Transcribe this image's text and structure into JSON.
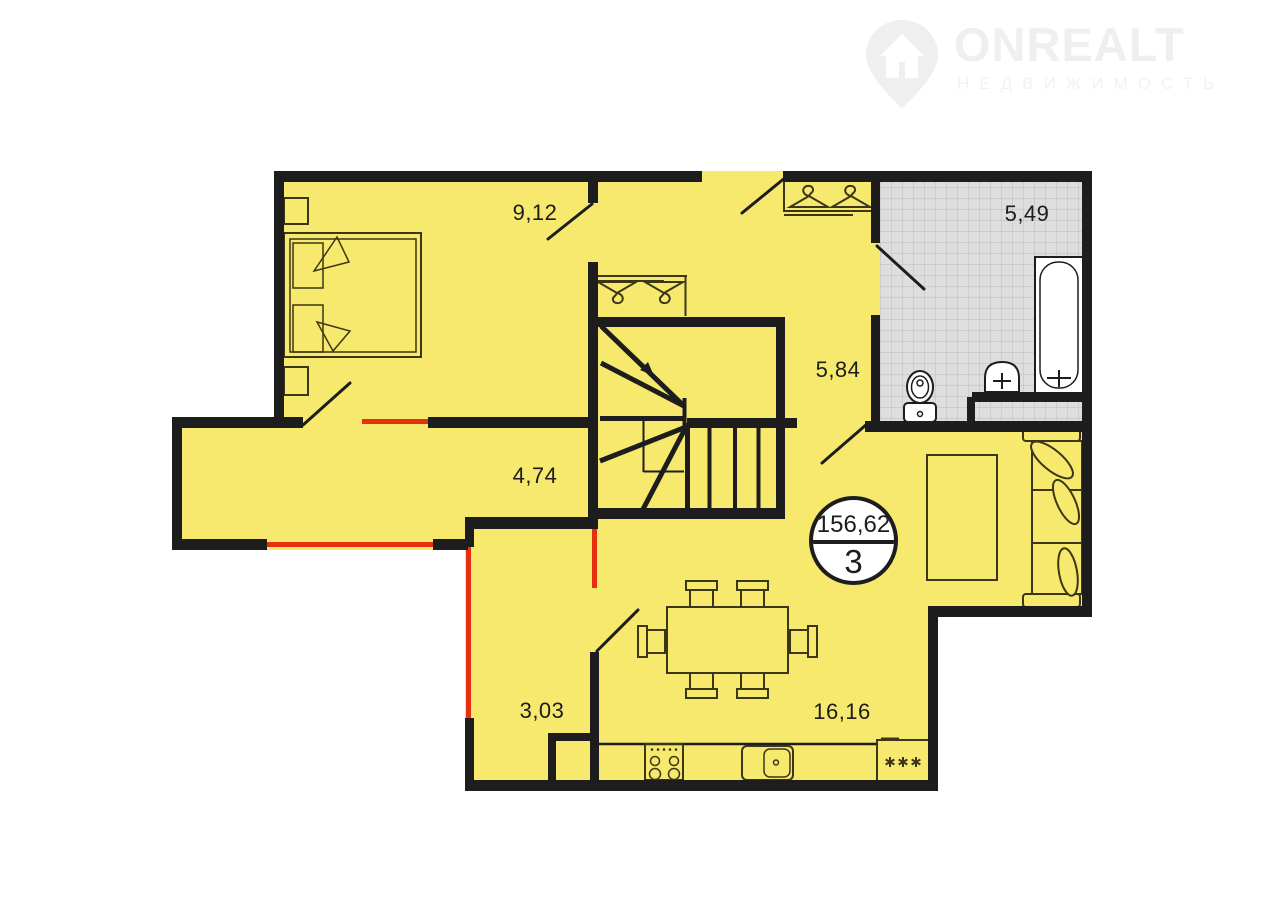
{
  "logo": {
    "brand": "ONREALT",
    "subtitle": "НЕДВИЖИМОСТЬ",
    "icon": "house-pin-icon"
  },
  "plan": {
    "badge": {
      "total_area": "156,62",
      "rooms_count": "3"
    },
    "rooms": [
      {
        "id": "bedroom",
        "area": "9,12"
      },
      {
        "id": "bathroom",
        "area": "5,49"
      },
      {
        "id": "hallway",
        "area": "5,84"
      },
      {
        "id": "corridor",
        "area": "4,74"
      },
      {
        "id": "storage",
        "area": "3,03"
      },
      {
        "id": "kitchen-living",
        "area": "16,16"
      }
    ],
    "colors": {
      "room_fill": "#f6e96d",
      "wall": "#1d1d1d",
      "highlight": "#e5310f",
      "tile_fill": "#dedede",
      "tile_line": "#bcbcbc",
      "fixture_fill": "#ffffff",
      "furniture_line": "#3b3616",
      "label": "#1c1c1c",
      "logo": "#efefef",
      "logo_sub": "#f2f2f2"
    }
  }
}
